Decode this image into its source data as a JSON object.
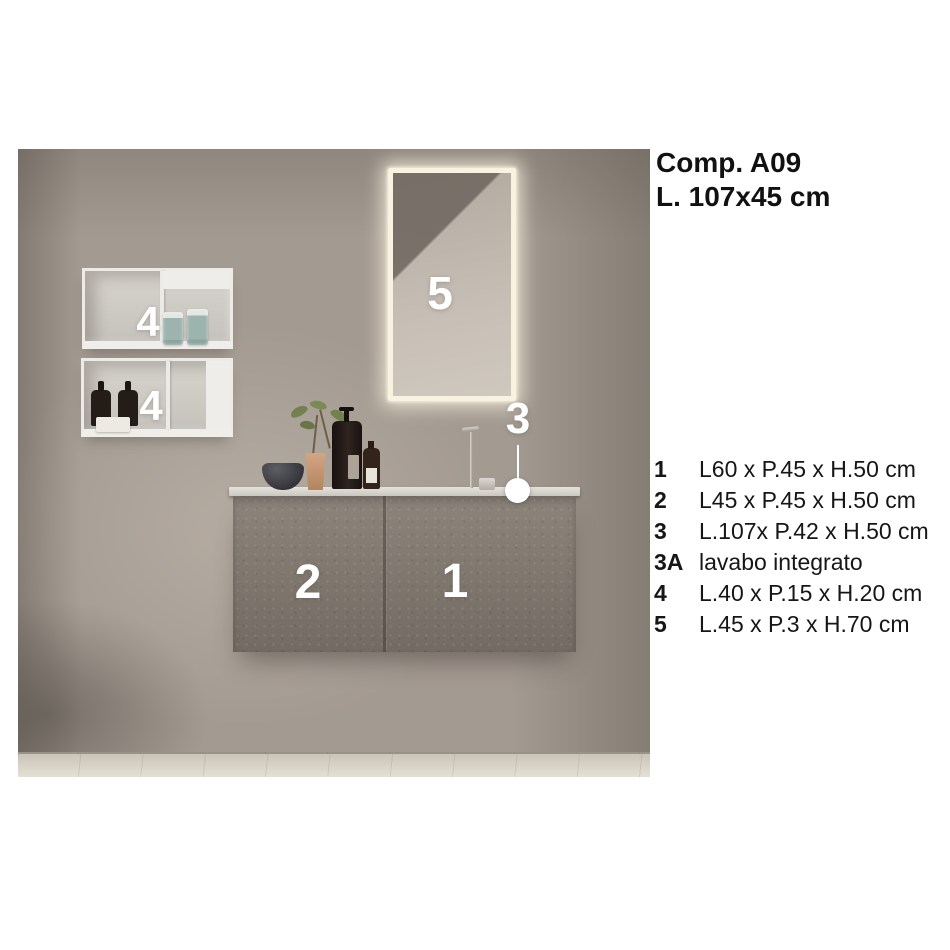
{
  "header": {
    "line1": "Comp. A09",
    "line2": "L. 107x45 cm"
  },
  "photo": {
    "labels": {
      "mirror": "5",
      "shelf_top": "4",
      "shelf_bottom": "4",
      "door_left": "2",
      "door_right": "1",
      "countertop": "3"
    }
  },
  "legend": {
    "items": [
      {
        "number": "1",
        "text": "L60 x P.45 x H.50 cm"
      },
      {
        "number": "2",
        "text": "L45 x P.45 x H.50 cm"
      },
      {
        "number": "3",
        "text": "L.107x P.42 x H.50 cm"
      },
      {
        "number": "3A",
        "text": "lavabo integrato"
      },
      {
        "number": "4",
        "text": "L.40 x P.15 x H.20 cm"
      },
      {
        "number": "5",
        "text": "L.45 x P.3 x H.70 cm"
      }
    ]
  },
  "colors": {
    "page_background": "#ffffff",
    "text": "#161616",
    "wall": "#a39a91",
    "cabinet": "#867d73",
    "countertop": "#dcd8d2",
    "mirror_glow": "#f9f2e1",
    "photo_label": "#ffffff"
  }
}
